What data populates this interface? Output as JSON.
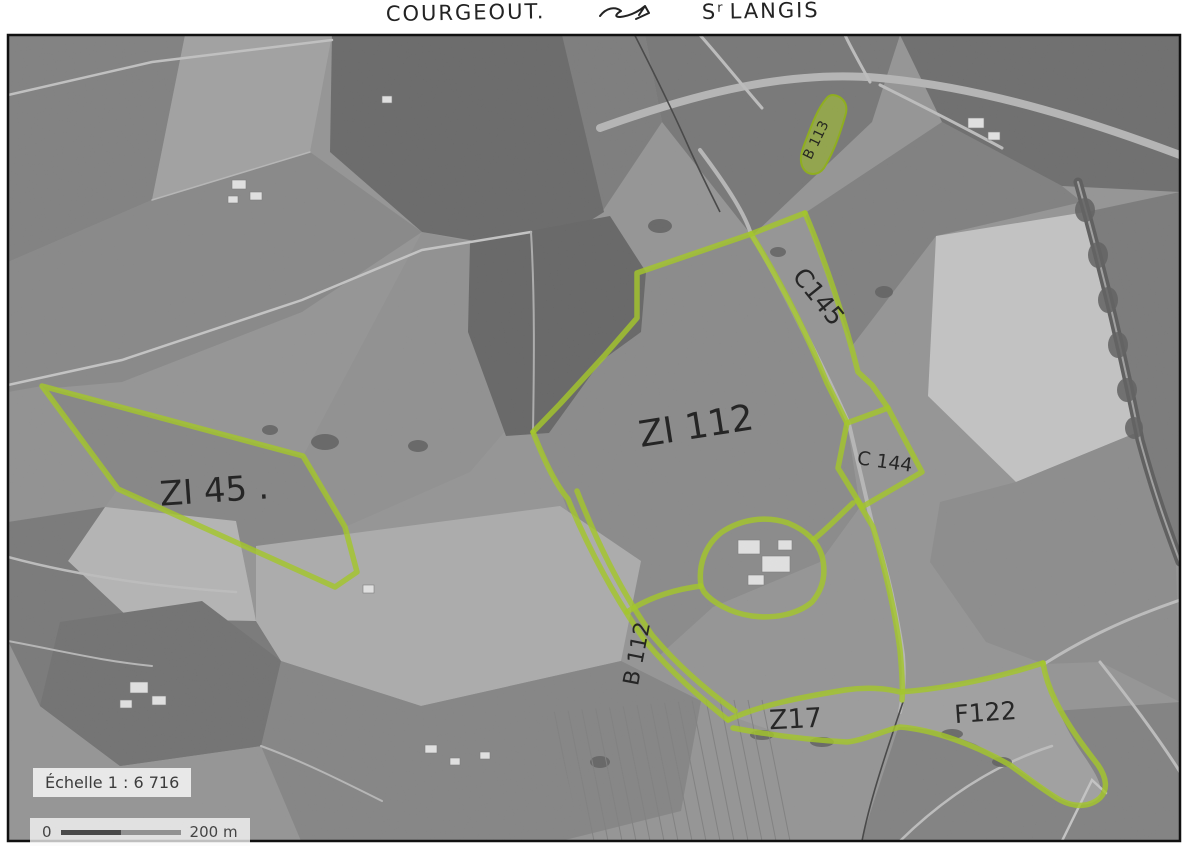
{
  "annotations": {
    "top_left_commune": "COURGEOUT.",
    "top_right_commune_prefix": "S",
    "top_right_commune_sup": "r",
    "top_right_commune_rest": "LANGIS",
    "arrow_icon": "double-arrow-sketch"
  },
  "map": {
    "kind": "aerial-photo-cadastral-scan",
    "highlight_color": "#a4c62c",
    "parcel_labels": [
      {
        "id": "zi45",
        "label": "ZI 45 ."
      },
      {
        "id": "zi112",
        "label": "ZI 112"
      },
      {
        "id": "c145",
        "label": "C145"
      },
      {
        "id": "c144",
        "label": "C 144"
      },
      {
        "id": "b112",
        "label": "B 112"
      },
      {
        "id": "b113",
        "label": "B 113"
      },
      {
        "id": "z17",
        "label": "Z17"
      },
      {
        "id": "f122",
        "label": "F122"
      }
    ],
    "scale": {
      "label": "Échelle 1 : 6 716",
      "bar_start": "0",
      "bar_end": "200 m"
    }
  }
}
